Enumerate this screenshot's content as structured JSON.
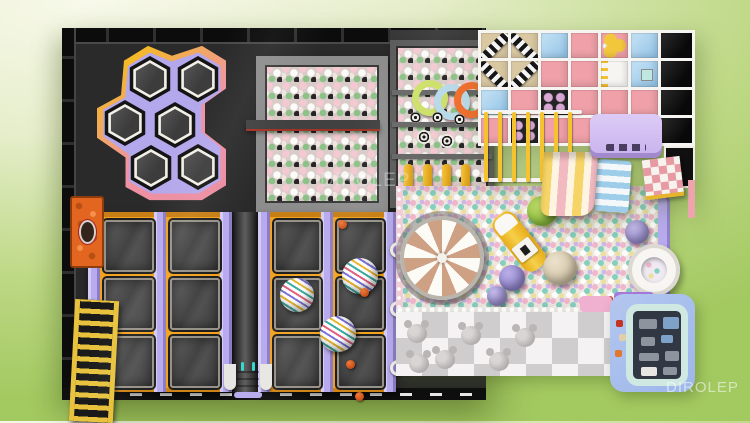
{
  "watermarks": {
    "center": "DIROLEP",
    "bottom_right": "DIROLEP"
  },
  "palette": {
    "floor-black": "#2a2a2a",
    "hex-purple": "#b4a8ec",
    "hex-pink": "#e98a9e",
    "hex-yellow": "#f4b82a",
    "foam-frame": "#8d8d8d",
    "foam-frame-dark": "#5c5c5c",
    "tramp-orange": "#f2a21f",
    "tramp-purple": "#b7aaee",
    "structure-white": "#f7f5f2",
    "structure-pink": "#efa0a8",
    "structure-blue": "#a6cfec",
    "platform-purple": "#c9b2ee",
    "slide-yellow": "#f6d468",
    "slide-pink": "#f2b9c1",
    "mat-gray": "#cfcdcd",
    "mat-white": "#f4f2f2",
    "playhouse-blue": "#9db7ea",
    "playhouse-mint": "#cfe8e2"
  },
  "scene": {
    "hex_pads": [
      [
        29,
        8
      ],
      [
        77,
        8
      ],
      [
        4,
        52
      ],
      [
        54,
        54
      ],
      [
        30,
        97
      ],
      [
        77,
        96
      ]
    ],
    "foam_rings": [
      {
        "x": 16,
        "y": 34,
        "color": "#cde06a"
      },
      {
        "x": 38,
        "y": 38,
        "color": "#b8d9e8"
      },
      {
        "x": 58,
        "y": 36,
        "color": "#f07030"
      }
    ],
    "foam_targets": [
      [
        14,
        66,
        11
      ],
      [
        36,
        66,
        11
      ],
      [
        58,
        68,
        11
      ],
      [
        21,
        84,
        14
      ],
      [
        44,
        88,
        14
      ]
    ],
    "foam_bars_x": [
      8,
      27,
      46,
      65
    ],
    "structure_cells": [
      [
        "zebra",
        "zebra",
        "blue",
        "pink",
        "dotsy",
        "blue",
        "black"
      ],
      [
        "zebra",
        "zebra",
        "pink",
        "pink",
        "ladd",
        "blue badge",
        "black"
      ],
      [
        "blue",
        "pink",
        "punch",
        "pink",
        "pink",
        "pink",
        "black"
      ],
      [
        "pink",
        "punch",
        "pink",
        "pink",
        "blue",
        "checker",
        "black"
      ]
    ],
    "yellow_bar_xs": [
      6,
      20,
      34,
      48,
      62,
      76,
      90
    ],
    "court_mats": {
      "a": {
        "left": 26,
        "cols": [
          16,
          82
        ],
        "w": 46,
        "rows": [
          8,
          66,
          124
        ],
        "h": 48,
        "rails": [
          0,
          66,
          132
        ]
      },
      "b": {
        "left": 196,
        "cols": [
          16,
          79
        ],
        "w": 43,
        "rows": [
          8,
          66,
          124
        ],
        "h": 48,
        "rails": [
          0,
          63,
          126
        ]
      }
    },
    "beach_balls": [
      [
        280,
        230,
        36
      ],
      [
        218,
        250,
        34
      ],
      [
        258,
        288,
        36
      ]
    ],
    "orange_balls": [
      [
        276,
        192
      ],
      [
        298,
        260
      ],
      [
        284,
        332
      ],
      [
        293,
        364
      ],
      [
        340,
        338
      ]
    ],
    "rail_rings": [
      [
        328,
        214
      ],
      [
        328,
        273
      ],
      [
        328,
        332
      ]
    ],
    "pit_balls": [
      {
        "x": 465,
        "y": 168,
        "r": 15,
        "c1": "#c2e06a",
        "c2": "#8cc23e"
      },
      {
        "x": 437,
        "y": 237,
        "r": 13,
        "c1": "#b9aee8",
        "c2": "#8f82cc"
      },
      {
        "x": 481,
        "y": 223,
        "r": 17,
        "c1": "#ece2cc",
        "c2": "#cdbfa2"
      },
      {
        "x": 563,
        "y": 192,
        "r": 12,
        "c1": "#c3b9ea",
        "c2": "#9a8ed2"
      },
      {
        "x": 425,
        "y": 258,
        "r": 10,
        "c1": "#c3b9ea",
        "c2": "#9a8ed2"
      }
    ],
    "red_dots": [
      [
        545,
        268
      ],
      [
        551,
        290
      ]
    ],
    "bear_tiles": [
      [
        8,
        6
      ],
      [
        62,
        8
      ],
      [
        116,
        10
      ],
      [
        36,
        32
      ],
      [
        90,
        34
      ],
      [
        10,
        36
      ]
    ],
    "toys": [
      [
        6,
        8,
        18,
        10,
        ""
      ],
      [
        30,
        6,
        16,
        12,
        "b"
      ],
      [
        8,
        26,
        14,
        9,
        ""
      ],
      [
        28,
        24,
        12,
        8,
        "b"
      ],
      [
        6,
        42,
        20,
        8,
        ""
      ],
      [
        32,
        40,
        14,
        10,
        ""
      ],
      [
        8,
        56,
        16,
        9,
        "w"
      ],
      [
        30,
        56,
        14,
        8,
        ""
      ]
    ],
    "ph_dots": [
      [
        6,
        26,
        "#c43224"
      ],
      [
        9,
        40,
        "#e0cfa8"
      ],
      [
        5,
        56,
        "#e07830"
      ]
    ]
  }
}
